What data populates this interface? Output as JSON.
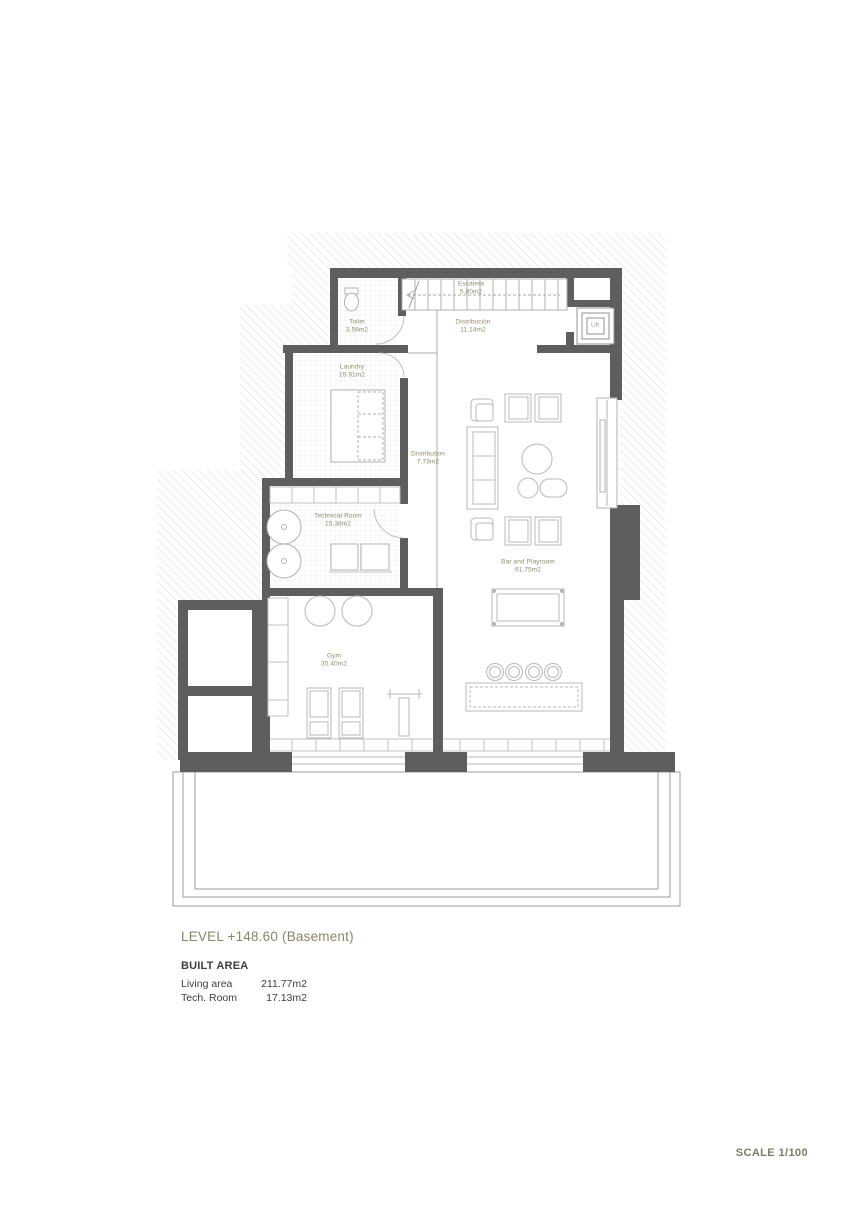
{
  "document": {
    "level_title": "LEVEL +148.60 (Basement)",
    "built_area_heading": "BUILT AREA",
    "area_rows": [
      {
        "label": "Living area",
        "value": "211.77m2"
      },
      {
        "label": "Tech. Room",
        "value": "17.13m2"
      }
    ],
    "scale_label": "SCALE 1/100"
  },
  "rooms": {
    "escalera": {
      "name": "Escalera",
      "area": "5.80m2"
    },
    "distribucion": {
      "name": "Distribución",
      "area": "11.14m2"
    },
    "toilet": {
      "name": "Toilet",
      "area": "3.56m2"
    },
    "lift": {
      "name": "Lift"
    },
    "laundry": {
      "name": "Laundry",
      "area": "15.91m2"
    },
    "distribution": {
      "name": "Distribution",
      "area": "7.73m2"
    },
    "technical_room": {
      "name": "Technical Room",
      "area": "15.38m2"
    },
    "gym": {
      "name": "Gym",
      "area": "35.40m2"
    },
    "bar_playroom": {
      "name": "Bar and Playroom",
      "area": "91.75m2"
    }
  },
  "colors": {
    "wall": "#5e5e5e",
    "hatch": "#d8d8d8",
    "label": "#94896a",
    "title": "#8d8463",
    "ink": "#3d3d3d",
    "scale": "#7f7966"
  }
}
